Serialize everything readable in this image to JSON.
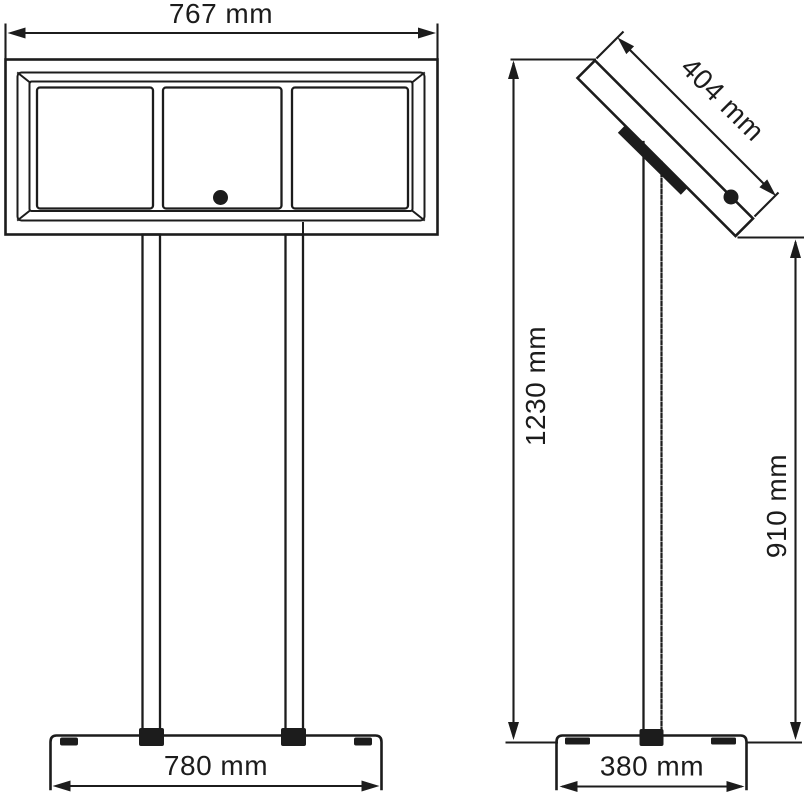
{
  "diagram": {
    "labels": {
      "front_width": "767 mm",
      "front_base_width": "780 mm",
      "panel_length": "404 mm",
      "total_height": "1230 mm",
      "pole_height": "910 mm",
      "side_base_depth": "380 mm"
    },
    "colors": {
      "line": "#1c1c1c",
      "background": "#ffffff"
    }
  }
}
